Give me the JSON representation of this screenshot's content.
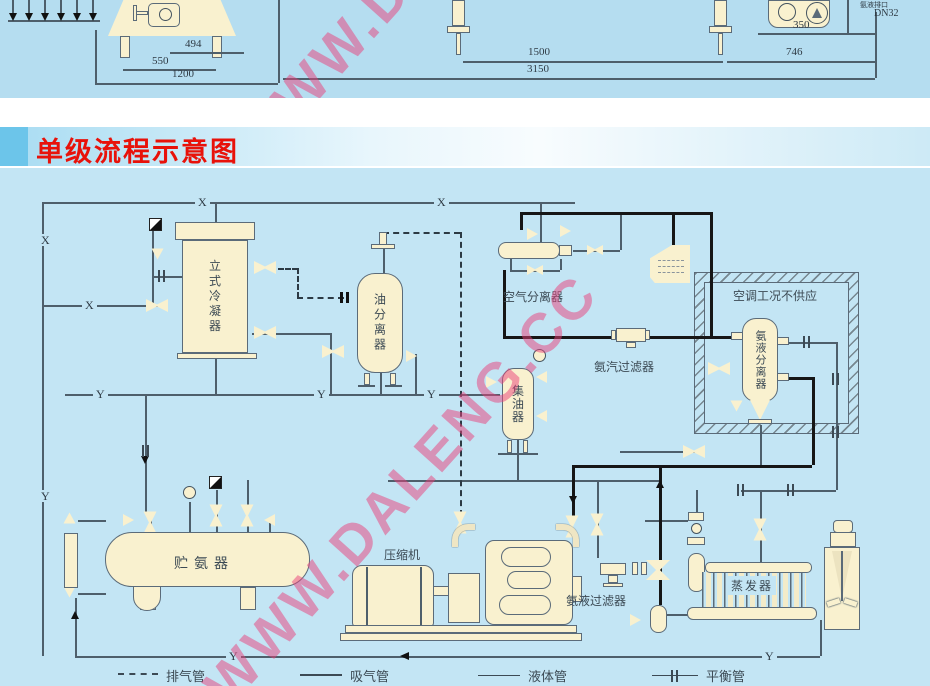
{
  "title": "单级流程示意图",
  "top_drawing": {
    "dim_494": "494",
    "dim_550": "550",
    "dim_1200": "1200",
    "dim_1500": "1500",
    "dim_3150": "3150",
    "dim_746": "746",
    "dim_350": "350",
    "port_label": "氨液排口",
    "port_dn": "DN32"
  },
  "diagram": {
    "labels": {
      "condenser": "立式冷凝器",
      "oil_separator": "油分离器",
      "air_separator": "空气分离器",
      "ac_note": "空调工况不供应",
      "vapor_filter": "氨汽过滤器",
      "liquid_separator": "氨液分离器",
      "oil_collector": "集油器",
      "receiver": "贮氨器",
      "compressor": "压缩机",
      "liquid_filter": "氨液过滤器",
      "evaporator": "蒸发器"
    },
    "pipe_labels": {
      "x": "X",
      "y": "Y"
    },
    "legend": [
      {
        "label": "排气管",
        "style": "dashed"
      },
      {
        "label": "吸气管",
        "style": "solid-thick"
      },
      {
        "label": "液体管",
        "style": "solid"
      },
      {
        "label": "平衡管",
        "style": "tick"
      }
    ],
    "watermark": "WWW.DALENG.CC"
  },
  "colors": {
    "title_red": "#e8120a",
    "diagram_bg": "#c3e5f4",
    "top_strip_bg": "#b5ddf0",
    "vessel_cream": "#f9f1cf",
    "outline": "#5b6b79",
    "thick_pipe": "#161616",
    "watermark_pink": "#e84078"
  }
}
